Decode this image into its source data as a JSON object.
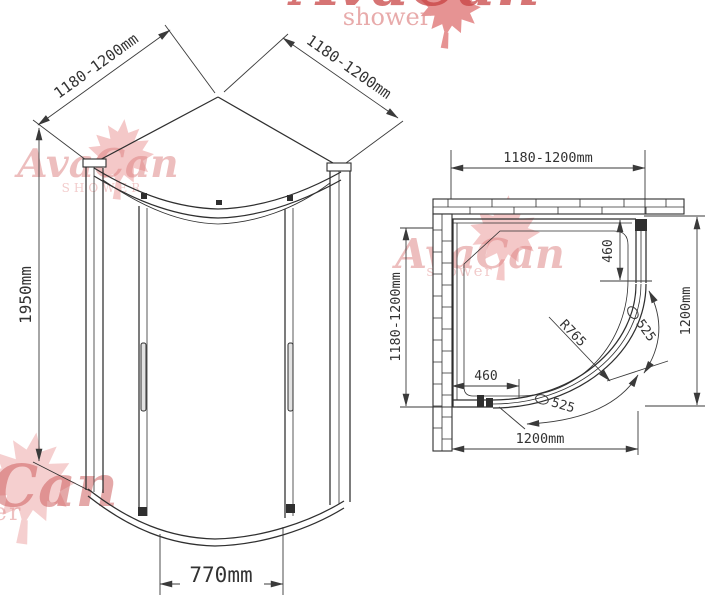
{
  "brand": {
    "name": "AvaCan",
    "tagline": "shower",
    "tagline_caps": "SHOWER"
  },
  "colors": {
    "line": "#2f2f2f",
    "dimension": "#3a3a3a",
    "watermark_red": "#cc5555",
    "watermark_pink": "#e6a6a6"
  },
  "iso_view": {
    "dim_top_left": "1180-1200mm",
    "dim_top_right": "1180-1200mm",
    "dim_height": "1950mm",
    "dim_door_opening": "770mm"
  },
  "plan_view": {
    "dim_top": "1180-1200mm",
    "dim_left": "1180-1200mm",
    "dim_right": "1200mm",
    "dim_bottom": "1200mm",
    "dim_fixed_panel_right": "460",
    "dim_fixed_panel_bottom": "460",
    "dim_radius": "R765",
    "dim_door_arc_upper": "525",
    "dim_door_arc_lower": "525"
  }
}
